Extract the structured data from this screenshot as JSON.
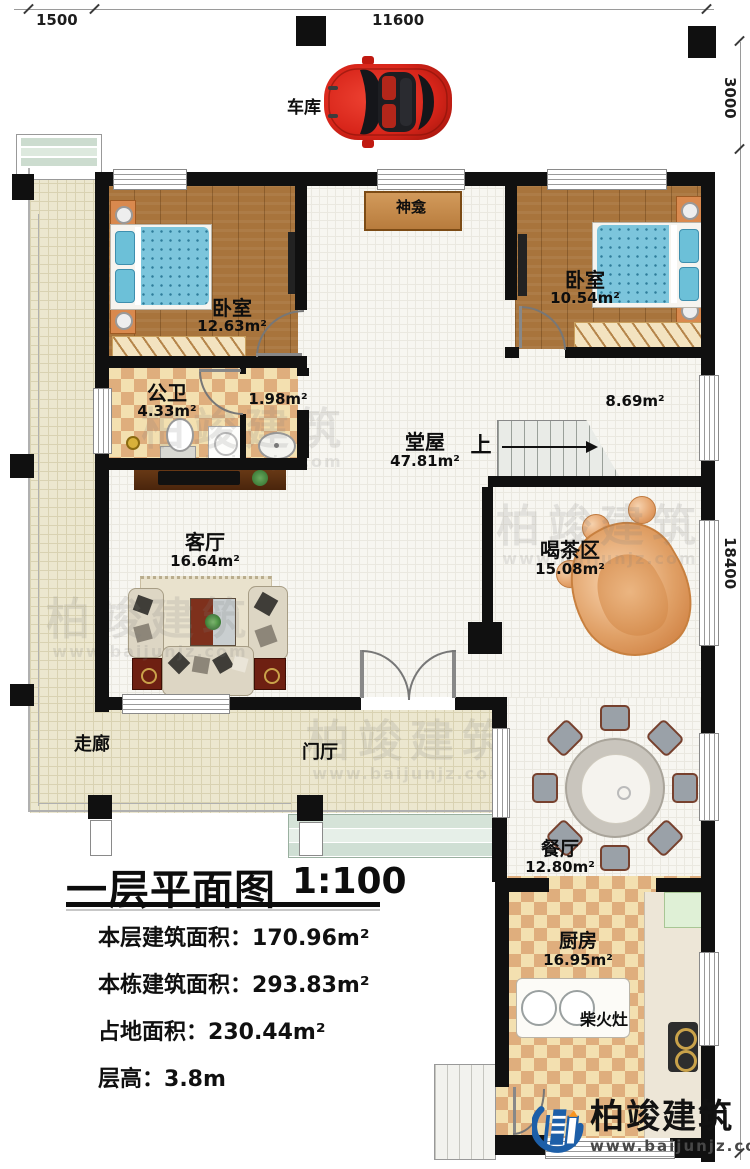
{
  "dimensions": {
    "top_left": "1500",
    "top_center": "11600",
    "right_upper": "3000",
    "right_lower": "18400"
  },
  "garage": {
    "label": "车库"
  },
  "rooms": {
    "shrine": {
      "name": "神龛"
    },
    "bedroom_left": {
      "name": "卧室",
      "area": "12.63m²"
    },
    "bedroom_right": {
      "name": "卧室",
      "area": "10.54m²"
    },
    "bathroom": {
      "name": "公卫",
      "area": "4.33m²"
    },
    "wash_area": {
      "area": "1.98m²"
    },
    "hall": {
      "name": "堂屋",
      "area": "47.81m²"
    },
    "upper_area": {
      "area": "8.69m²"
    },
    "stairs": {
      "label": "上"
    },
    "living_room": {
      "name": "客厅",
      "area": "16.64m²"
    },
    "tea_area": {
      "name": "喝茶区",
      "area": "15.08m²"
    },
    "corridor": {
      "name": "走廊"
    },
    "foyer": {
      "name": "门厅"
    },
    "dining": {
      "name": "餐厅",
      "area": "12.80m²"
    },
    "kitchen": {
      "name": "厨房",
      "area": "16.95m²"
    },
    "wood_stove": {
      "name": "柴火灶"
    }
  },
  "title_block": {
    "title": "一层平面图",
    "scale": "1:100",
    "items": [
      {
        "label": "本层建筑面积：",
        "value": "170.96m²"
      },
      {
        "label": "本栋建筑面积：",
        "value": "293.83m²"
      },
      {
        "label": "占地面积：",
        "value": "230.44m²"
      },
      {
        "label": "层高：",
        "value": "3.8m"
      }
    ]
  },
  "branding": {
    "name": "柏竣建筑",
    "website": "www.baijunjz.com"
  },
  "watermark": {
    "text": "柏竣建筑",
    "subtext": "www.baijunjz.com"
  },
  "colors": {
    "wall": "#101010",
    "brand_blue": "#1d5fa8",
    "brand_orange": "#f7941d",
    "car_red": "#d8251a",
    "wood_floor": "#a8743c",
    "corridor_tile": "#ece7cf",
    "checker_tile": "#dfae7d"
  }
}
